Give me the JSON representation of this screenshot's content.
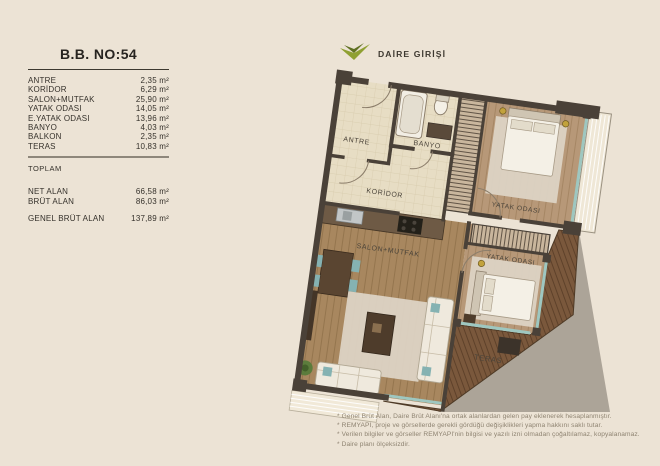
{
  "page": {
    "background": "#ece3d5"
  },
  "panel": {
    "title": "B.B. NO:54",
    "rooms": [
      {
        "label": "ANTRE",
        "value": "2,35 m²"
      },
      {
        "label": "KORİDOR",
        "value": "6,29 m²"
      },
      {
        "label": "SALON+MUTFAK",
        "value": "25,90 m²"
      },
      {
        "label": "YATAK ODASI",
        "value": "14,05 m²"
      },
      {
        "label": "E.YATAK ODASI",
        "value": "13,96 m²"
      },
      {
        "label": "BANYO",
        "value": "4,03 m²"
      },
      {
        "label": "BALKON",
        "value": "2,35 m²"
      },
      {
        "label": "TERAS",
        "value": "10,83 m²"
      }
    ],
    "toplam_label": "TOPLAM",
    "totals": [
      {
        "label": "NET ALAN",
        "value": "66,58 m²"
      },
      {
        "label": "BRÜT ALAN",
        "value": "86,03 m²"
      }
    ],
    "genel": {
      "label": "GENEL BRÜT ALAN",
      "value": "137,89 m²"
    }
  },
  "plan": {
    "entrance_label": "DAİRE GİRİŞİ",
    "arrow_color": "#8fa032",
    "room_labels": {
      "antre": "ANTRE",
      "banyo": "BANYO",
      "koridor": "KORİDOR",
      "yatak1": "YATAK ODASI",
      "salon": "SALON+MUTFAK",
      "yatak2": "YATAK ODASI",
      "teras": "TERAS"
    },
    "colors": {
      "wall": "#4a4138",
      "tile": "#e7ddc4",
      "wood": "#a8875f",
      "wood_light": "#b79878",
      "deck": "#7a583c",
      "glass": "#9ec7c0",
      "rug": "#dcd3c4",
      "teal": "#85b2b2",
      "shadow": "#a59c91"
    }
  },
  "footnotes": [
    "* Genel Brüt Alan, Daire Brüt Alanı'na ortak alanlardan gelen pay eklenerek hesaplanmıştır.",
    "* REMYAPI, proje ve görsellerde gerekli gördüğü değişiklikleri yapma hakkını saklı tutar.",
    "* Verilen bilgiler ve görseller REMYAPI'nin bilgisi ve yazılı izni olmadan çoğaltılamaz, kopyalanamaz.",
    "* Daire planı ölçeksizdir."
  ]
}
